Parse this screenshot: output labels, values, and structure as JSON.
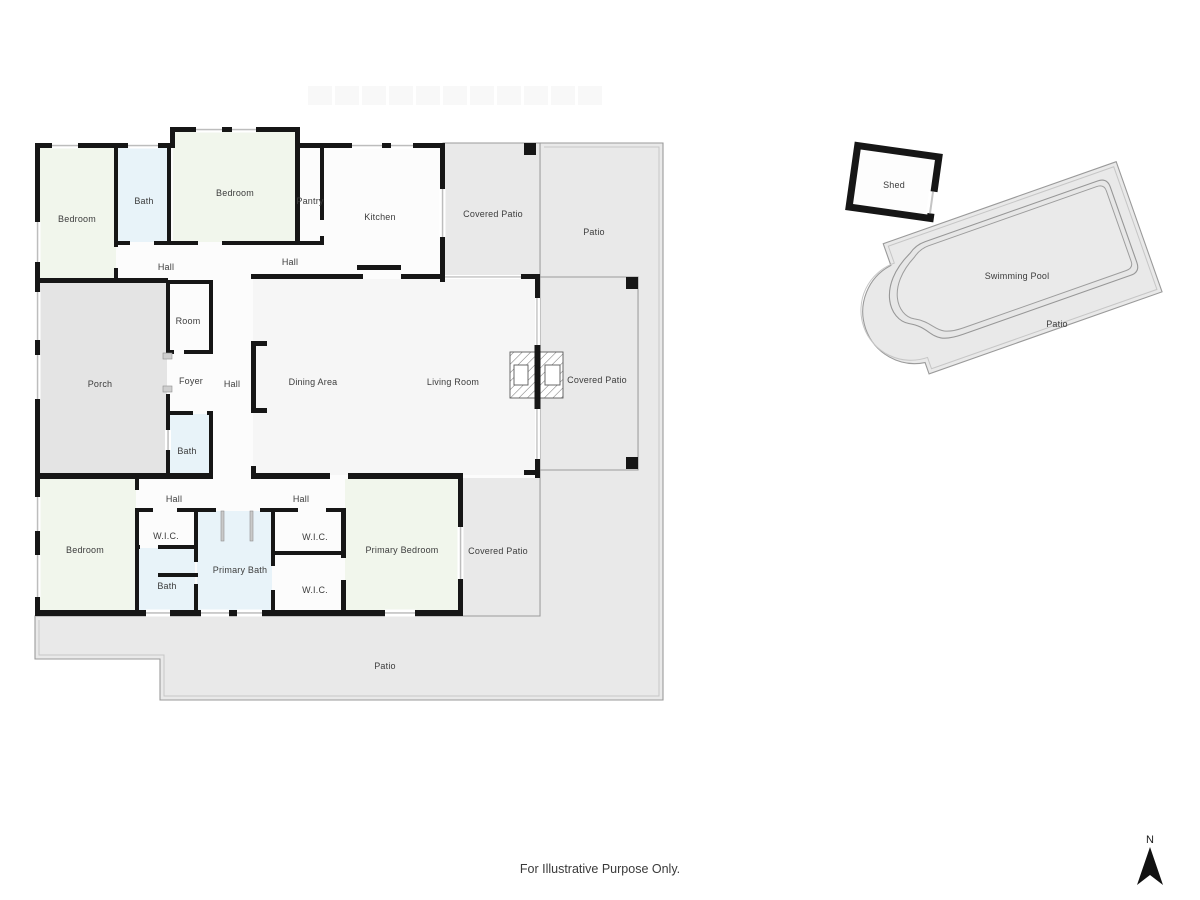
{
  "footer": {
    "note": "For Illustrative Purpose Only."
  },
  "compass": {
    "north_label": "N"
  },
  "colors": {
    "wall": "#161616",
    "room_fill": "#fcfcfc",
    "living_fill": "#f6f6f6",
    "bedroom_fill": "#f1f6ec",
    "bath_fill": "#e8f3f9",
    "porch_fill": "#e4e4e4",
    "patio_fill": "#e9e9e9",
    "patio_border": "#9a9a9a",
    "window": "#bdbdbd",
    "label_text": "#3c3c3c"
  },
  "rooms": {
    "bedroom_tl": "Bedroom",
    "bath_tl": "Bath",
    "bedroom_top": "Bedroom",
    "pantry": "Pantry",
    "kitchen": "Kitchen",
    "covered_patio_top": "Covered Patio",
    "patio_top": "Patio",
    "hall_1": "Hall",
    "hall_2": "Hall",
    "room": "Room",
    "porch": "Porch",
    "foyer": "Foyer",
    "hall_3": "Hall",
    "dining": "Dining Area",
    "living": "Living Room",
    "covered_patio_right": "Covered Patio",
    "bath_mid": "Bath",
    "hall_4": "Hall",
    "hall_5": "Hall",
    "bedroom_bl": "Bedroom",
    "wic_left": "W.I.C.",
    "bath_bl": "Bath",
    "primary_bath": "Primary Bath",
    "wic_top": "W.I.C.",
    "wic_bottom": "W.I.C.",
    "primary_bedroom": "Primary Bedroom",
    "covered_patio_bottom": "Covered Patio",
    "patio_bottom": "Patio",
    "shed": "Shed",
    "swimming_pool": "Swimming Pool",
    "pool_patio": "Patio"
  }
}
